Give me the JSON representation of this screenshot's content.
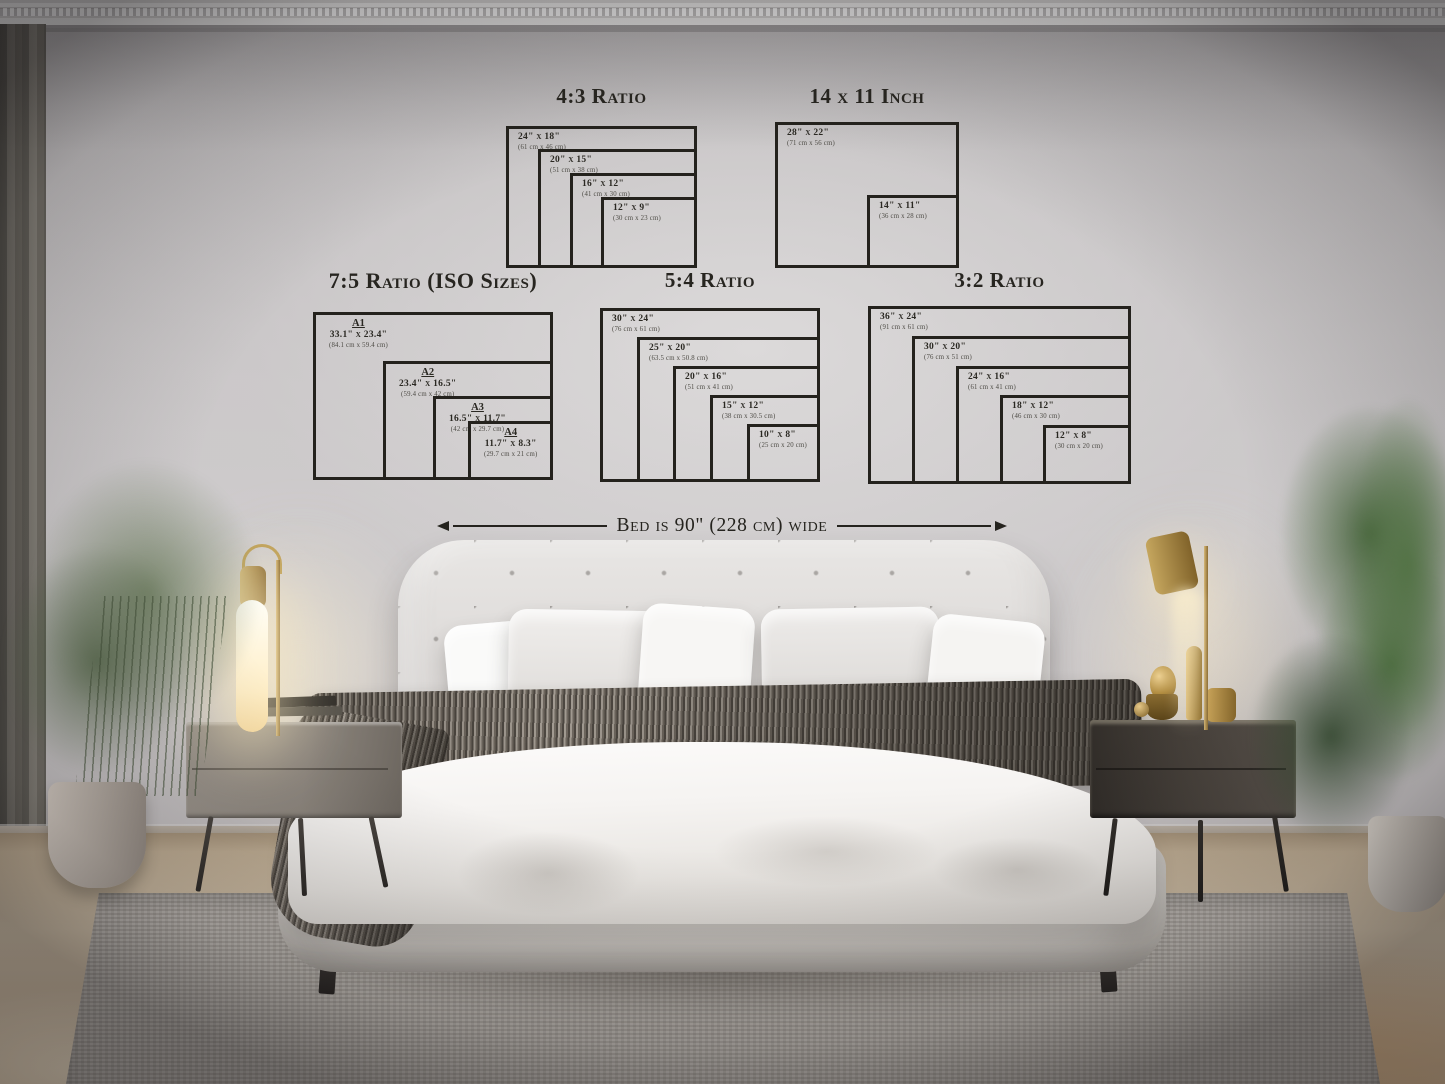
{
  "groups": [
    {
      "title": "4:3 Ratio",
      "frames": [
        {
          "size": "24\" x 18\"",
          "metric": "(61 cm x 46 cm)"
        },
        {
          "size": "20\" x 15\"",
          "metric": "(51 cm x 38 cm)"
        },
        {
          "size": "16\" x 12\"",
          "metric": "(41 cm x 30 cm)"
        },
        {
          "size": "12\" x 9\"",
          "metric": "(30 cm x 23 cm)"
        }
      ]
    },
    {
      "title": "14 x 11 Inch",
      "frames": [
        {
          "size": "28\" x 22\"",
          "metric": "(71 cm x 56 cm)"
        },
        {
          "size": "14\" x 11\"",
          "metric": "(36 cm x 28 cm)"
        }
      ]
    },
    {
      "title": "7:5 Ratio (ISO Sizes)",
      "frames": [
        {
          "label": "A1",
          "size": "33.1\" x 23.4\"",
          "metric": "(84.1 cm x 59.4 cm)"
        },
        {
          "label": "A2",
          "size": "23.4\" x 16.5\"",
          "metric": "(59.4 cm x 42 cm)"
        },
        {
          "label": "A3",
          "size": "16.5\" x 11.7\"",
          "metric": "(42 cm x 29.7 cm)"
        },
        {
          "label": "A4",
          "size": "11.7\" x 8.3\"",
          "metric": "(29.7 cm x 21 cm)"
        }
      ]
    },
    {
      "title": "5:4 Ratio",
      "frames": [
        {
          "size": "30\" x 24\"",
          "metric": "(76 cm x 61 cm)"
        },
        {
          "size": "25\" x 20\"",
          "metric": "(63.5 cm x 50.8 cm)"
        },
        {
          "size": "20\" x 16\"",
          "metric": "(51 cm x 41 cm)"
        },
        {
          "size": "15\" x 12\"",
          "metric": "(38 cm x 30.5 cm)"
        },
        {
          "size": "10\" x 8\"",
          "metric": "(25 cm x 20 cm)"
        }
      ]
    },
    {
      "title": "3:2 Ratio",
      "frames": [
        {
          "size": "36\" x 24\"",
          "metric": "(91 cm x 61 cm)"
        },
        {
          "size": "30\" x 20\"",
          "metric": "(76 cm x 51 cm)"
        },
        {
          "size": "24\" x 16\"",
          "metric": "(61 cm x 41 cm)"
        },
        {
          "size": "18\" x 12\"",
          "metric": "(46 cm x 30 cm)"
        },
        {
          "size": "12\" x 8\"",
          "metric": "(30 cm x 20 cm)"
        }
      ]
    }
  ],
  "annotation": {
    "bed_width": "Bed is 90\" (228 cm) wide"
  },
  "colors": {
    "ink": "#2a2822",
    "wall_light": "#d6d4d4",
    "wall_dark": "#a5a2a3",
    "brass": "#c2a362",
    "plant_green": "#47663d",
    "wood_floor": "#cdbca4",
    "rug": "#b7b2ac",
    "blanket": "#7d7770",
    "bed_white": "#f5f3f1"
  }
}
